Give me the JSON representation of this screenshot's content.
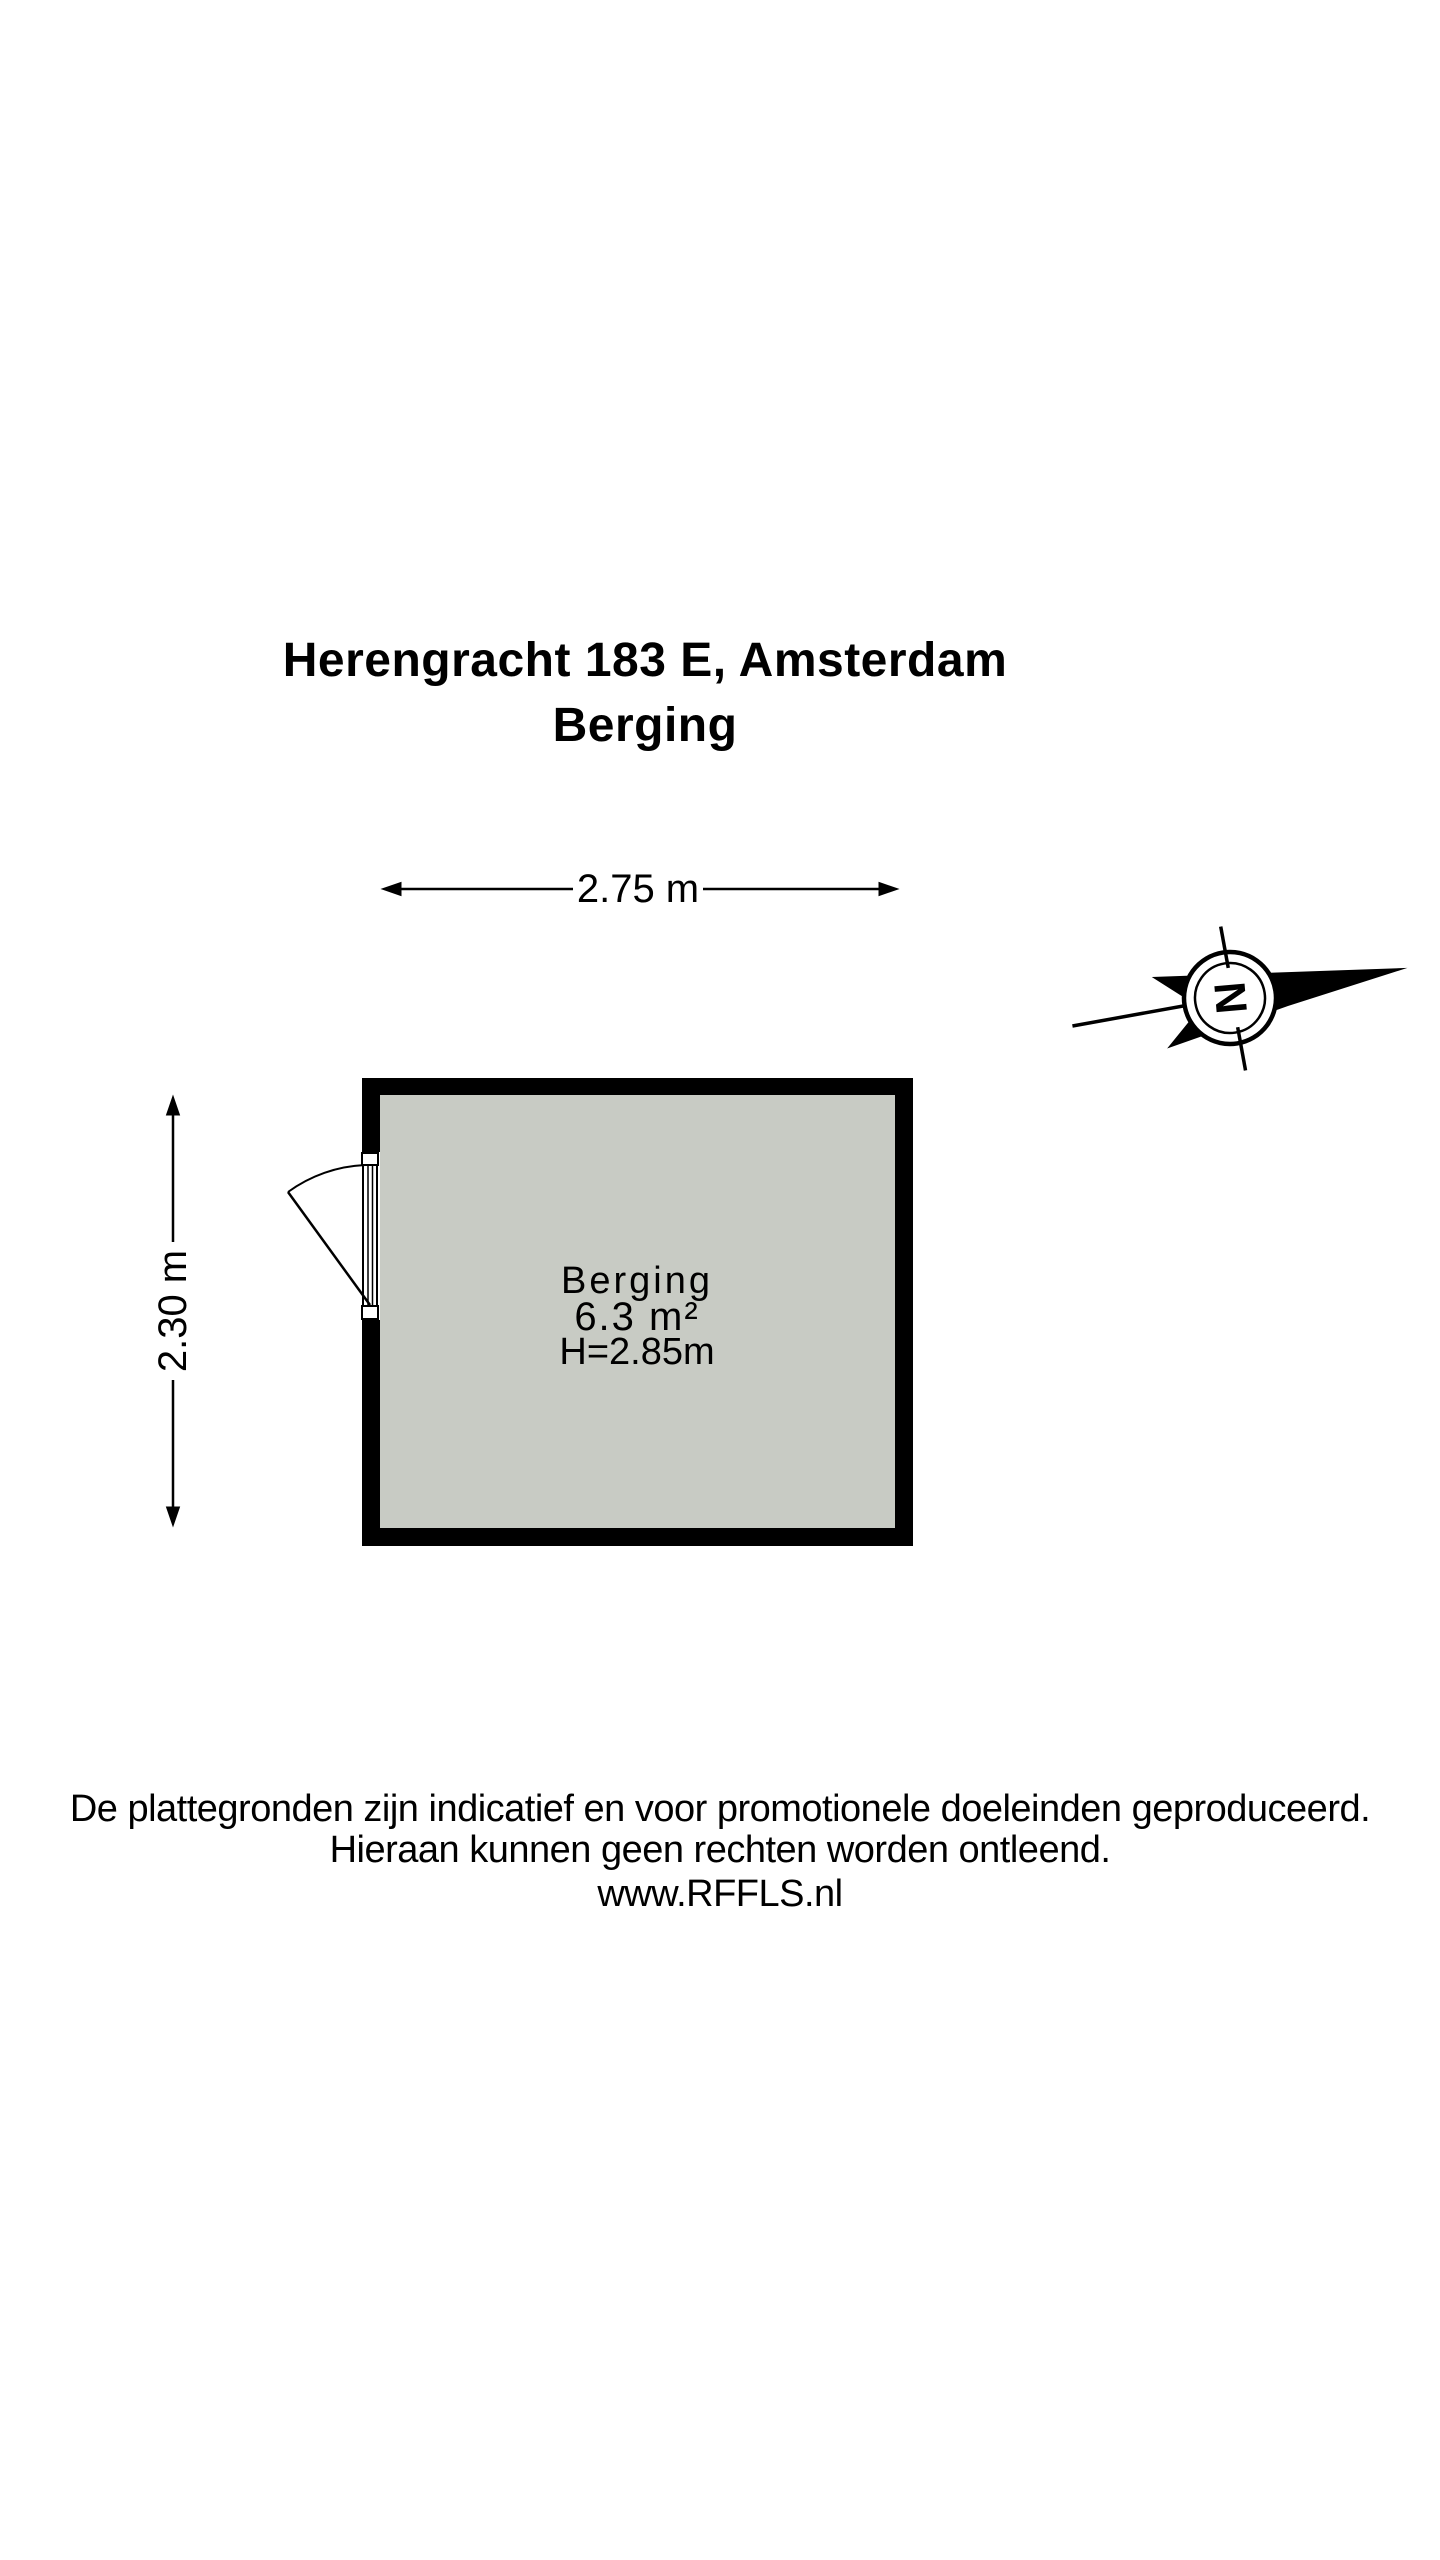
{
  "title": {
    "line1": "Herengracht 183 E, Amsterdam",
    "line2": "Berging"
  },
  "floor_plan": {
    "room": {
      "name": "Berging",
      "area": "6.3 m²",
      "ceiling_height": "H=2.85m"
    },
    "dimensions": {
      "width": "2.75 m",
      "depth": "2.30 m"
    },
    "compass": {
      "letter": "N"
    },
    "colors": {
      "wall": "#000000",
      "room_fill": "#c8cbc4",
      "line": "#000000"
    }
  },
  "footer": {
    "line1": "De plattegronden zijn indicatief en voor promotionele doeleinden geproduceerd.",
    "line2": "Hieraan kunnen geen rechten worden ontleend.",
    "line3": "www.RFFLS.nl"
  }
}
